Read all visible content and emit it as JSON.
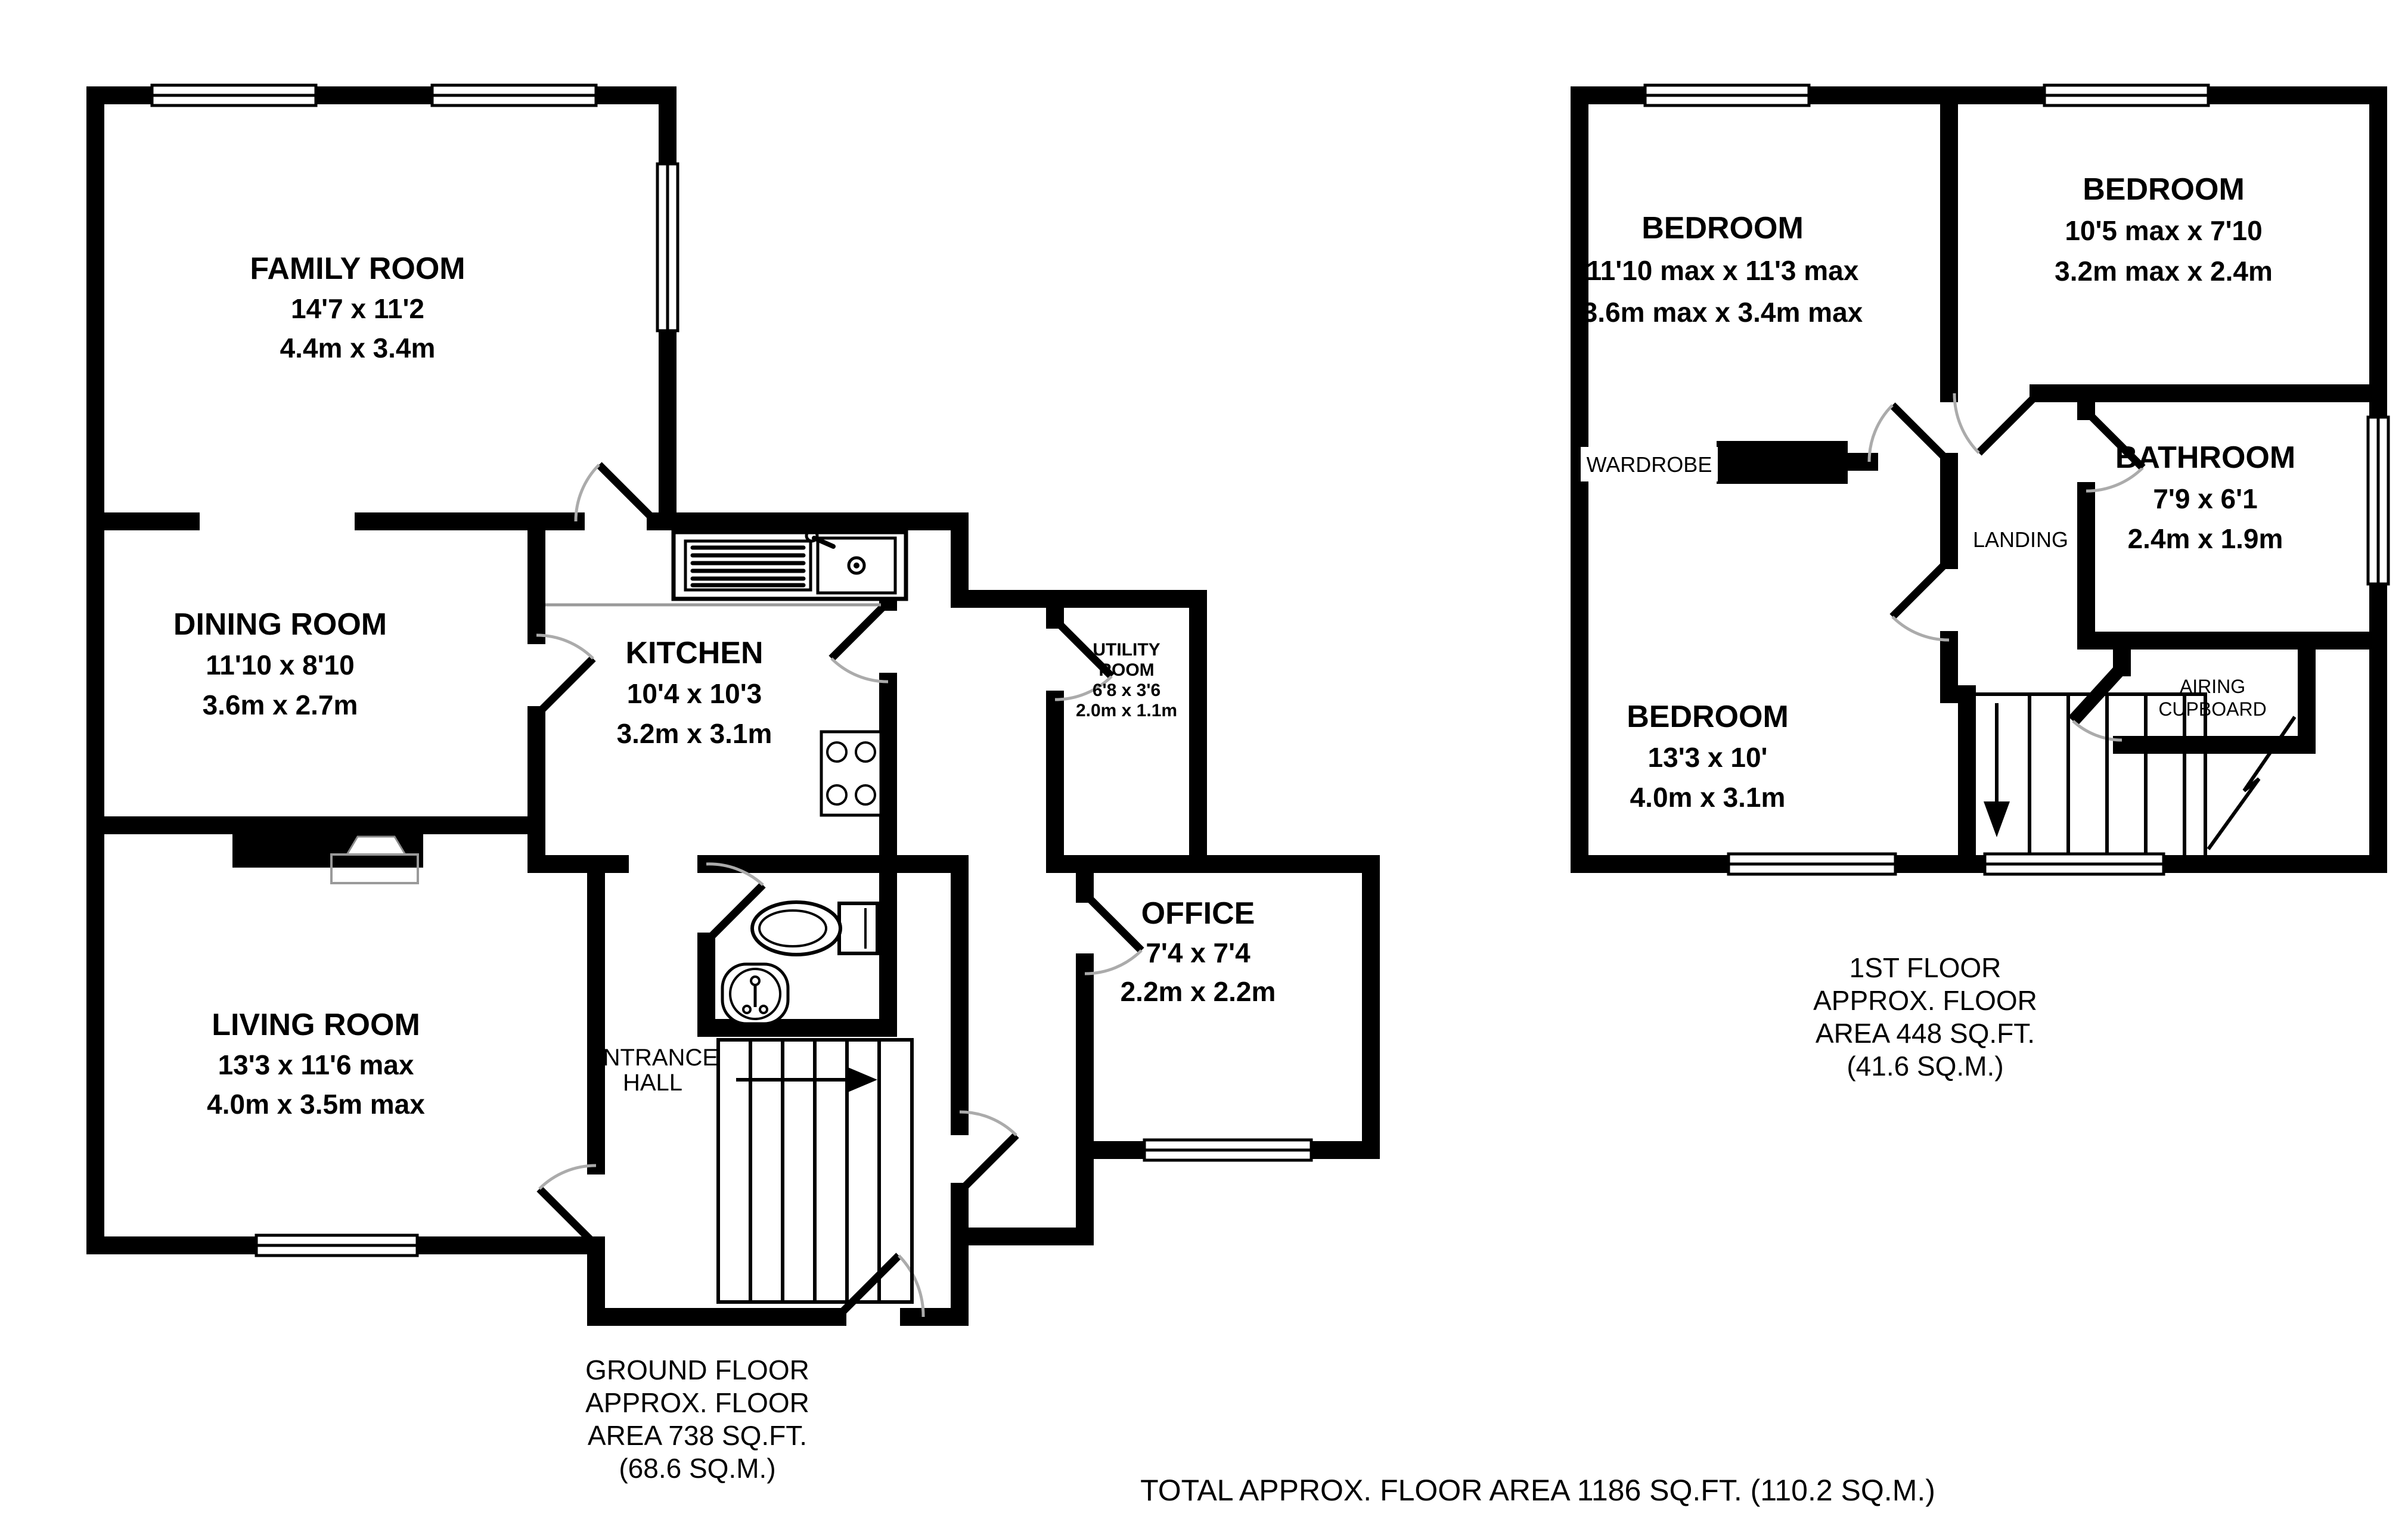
{
  "colors": {
    "wall": "#000000",
    "door_leaf": "#000000",
    "door_arc": "#ababab",
    "counter_line": "#9a9a9a",
    "floor": "#ffffff"
  },
  "ground_floor": {
    "caption": [
      "GROUND FLOOR",
      "APPROX. FLOOR",
      "AREA 738 SQ.FT.",
      "(68.6 SQ.M.)"
    ],
    "rooms": {
      "family": {
        "name": "FAMILY ROOM",
        "imperial": "14'7 x 11'2",
        "metric": "4.4m x 3.4m"
      },
      "dining": {
        "name": "DINING ROOM",
        "imperial": "11'10 x 8'10",
        "metric": "3.6m x 2.7m"
      },
      "kitchen": {
        "name": "KITCHEN",
        "imperial": "10'4 x 10'3",
        "metric": "3.2m x 3.1m"
      },
      "utility": {
        "name_line1": "UTILITY",
        "name_line2": "ROOM",
        "imperial": "6'8 x 3'6",
        "metric": "2.0m x 1.1m"
      },
      "office": {
        "name": "OFFICE",
        "imperial": "7'4 x 7'4",
        "metric": "2.2m x 2.2m"
      },
      "living": {
        "name": "LIVING ROOM",
        "imperial": "13'3 x 11'6 max",
        "metric": "4.0m x 3.5m max"
      },
      "hall": {
        "name_line1": "ENTRANCE",
        "name_line2": "HALL"
      }
    }
  },
  "first_floor": {
    "caption": [
      "1ST FLOOR",
      "APPROX. FLOOR",
      "AREA 448 SQ.FT.",
      "(41.6 SQ.M.)"
    ],
    "rooms": {
      "bedroom1": {
        "name": "BEDROOM",
        "imperial": "11'10 max x 11'3 max",
        "metric": "3.6m max x 3.4m max"
      },
      "bedroom2": {
        "name": "BEDROOM",
        "imperial": "10'5 max x 7'10",
        "metric": "3.2m max x 2.4m"
      },
      "bedroom3": {
        "name": "BEDROOM",
        "imperial": "13'3 x 10'",
        "metric": "4.0m x 3.1m"
      },
      "bathroom": {
        "name": "BATHROOM",
        "imperial": "7'9 x 6'1",
        "metric": "2.4m x 1.9m"
      },
      "landing": {
        "name": "LANDING"
      },
      "wardrobe": {
        "name": "WARDROBE"
      },
      "airing": {
        "name_line1": "AIRING",
        "name_line2": "CUPBOARD"
      }
    }
  },
  "footer": {
    "total": "TOTAL APPROX. FLOOR AREA 1186 SQ.FT. (110.2 SQ.M.)"
  }
}
